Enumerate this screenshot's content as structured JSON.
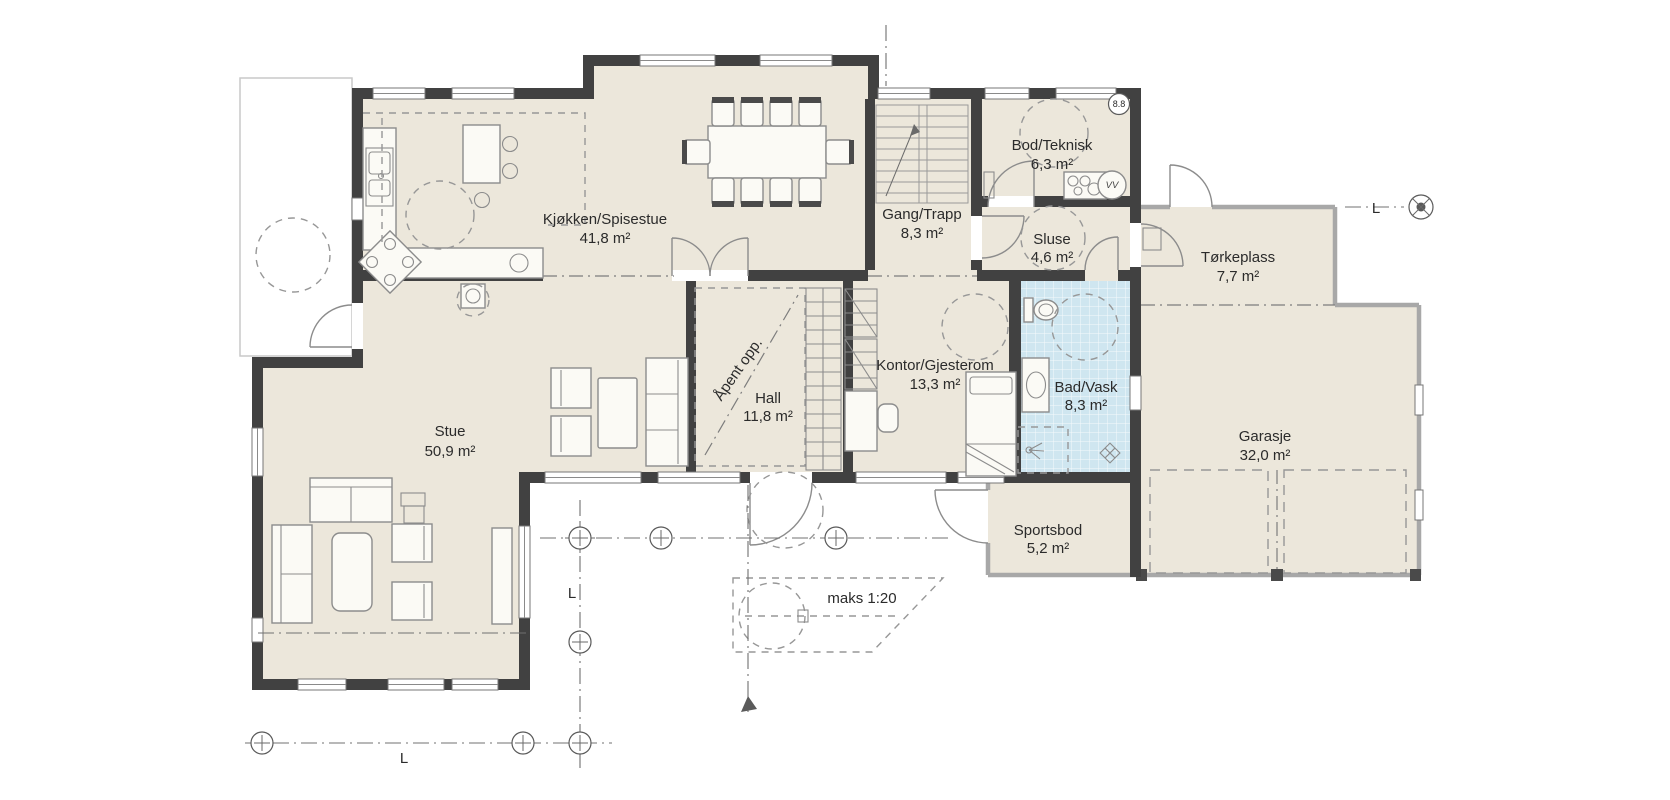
{
  "plan": {
    "rooms": [
      {
        "name": "Kjøkken/Spisestue",
        "area": "41,8 m²"
      },
      {
        "name": "Gang/Trapp",
        "area": "8,3 m²"
      },
      {
        "name": "Bod/Teknisk",
        "area": "6,3 m²"
      },
      {
        "name": "Sluse",
        "area": "4,6 m²"
      },
      {
        "name": "Tørkeplass",
        "area": "7,7 m²"
      },
      {
        "name": "Kontor/Gjesterom",
        "area": "13,3 m²"
      },
      {
        "name": "Hall",
        "area": "11,8 m²"
      },
      {
        "name": "Bad/Vask",
        "area": "8,3 m²"
      },
      {
        "name": "Stue",
        "area": "50,9 m²"
      },
      {
        "name": "Garasje",
        "area": "32,0 m²"
      },
      {
        "name": "Sportsbod",
        "area": "5,2 m²"
      }
    ],
    "annotations": {
      "open_above": "Åpent opp.",
      "ramp_slope": "maks 1:20",
      "grid_label": "L",
      "detail_bubble": "8.8",
      "water_heater": "VV"
    },
    "colors": {
      "wall": "#414141",
      "floor": "#ece7db",
      "bath_tile": "#cfe6f0",
      "thin_wall": "#a8a8a8"
    }
  }
}
